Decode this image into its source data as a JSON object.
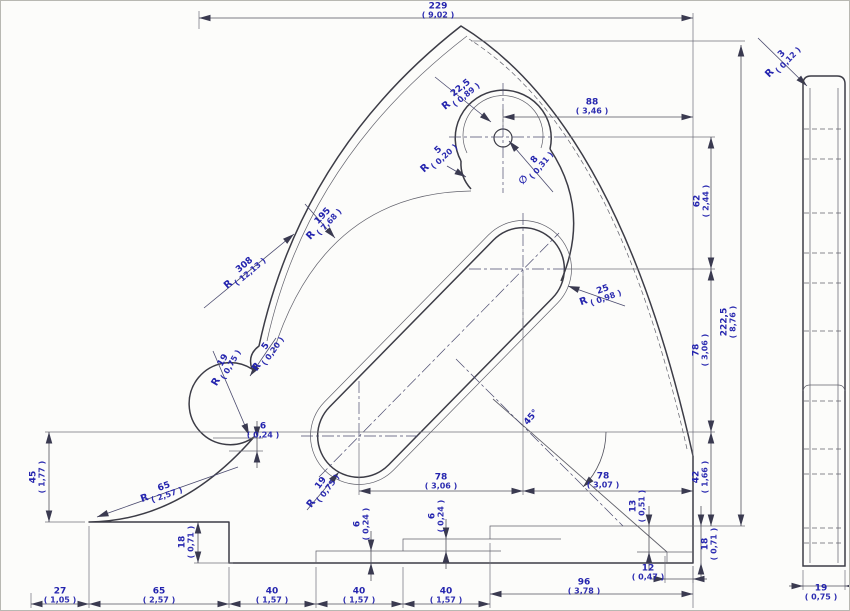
{
  "drawing": {
    "title": "gusset-bracket-technical-drawing",
    "views": {
      "main": "front-view",
      "side": "side-profile-view"
    },
    "colors": {
      "linework": "#3c3c46",
      "thin_line": "#60606a",
      "dimension_text": "#2424ae",
      "background": "#fcfcfa"
    },
    "labels": [
      {
        "name": "dim-overall-width",
        "prefix": "",
        "mm": "229",
        "in": "9,02",
        "x": 437,
        "y": 10,
        "rot": 0
      },
      {
        "name": "dim-hole-offset",
        "prefix": "",
        "mm": "88",
        "in": "3,46",
        "x": 591,
        "y": 106,
        "rot": 0
      },
      {
        "name": "dim-hole-to-slot",
        "prefix": "",
        "mm": "62",
        "in": "2,44",
        "x": 701,
        "y": 200,
        "rot": -90
      },
      {
        "name": "dim-slot-height",
        "prefix": "",
        "mm": "78",
        "in": "3,06",
        "x": 700,
        "y": 349,
        "rot": -90
      },
      {
        "name": "dim-overall-height",
        "prefix": "",
        "mm": "222,5",
        "in": "8,76",
        "x": 728,
        "y": 321,
        "rot": -90
      },
      {
        "name": "dim-edge-height-42",
        "prefix": "",
        "mm": "42",
        "in": "1,66",
        "x": 700,
        "y": 476,
        "rot": -90
      },
      {
        "name": "dim-step-13",
        "prefix": "",
        "mm": "13",
        "in": "0,51",
        "x": 637,
        "y": 505,
        "rot": -90
      },
      {
        "name": "dim-step-18-right",
        "prefix": "",
        "mm": "18",
        "in": "0,71",
        "x": 709,
        "y": 543,
        "rot": -90
      },
      {
        "name": "dim-notch-12",
        "prefix": "",
        "mm": "12",
        "in": "0,47",
        "x": 647,
        "y": 572,
        "rot": 0
      },
      {
        "name": "dim-base-96",
        "prefix": "",
        "mm": "96",
        "in": "3,78",
        "x": 583,
        "y": 586,
        "rot": 0
      },
      {
        "name": "dim-base-40-3",
        "prefix": "",
        "mm": "40",
        "in": "1,57",
        "x": 445,
        "y": 595,
        "rot": 0
      },
      {
        "name": "dim-base-40-2",
        "prefix": "",
        "mm": "40",
        "in": "1,57",
        "x": 358,
        "y": 595,
        "rot": 0
      },
      {
        "name": "dim-base-40-1",
        "prefix": "",
        "mm": "40",
        "in": "1,57",
        "x": 271,
        "y": 595,
        "rot": 0
      },
      {
        "name": "dim-base-65",
        "prefix": "",
        "mm": "65",
        "in": "2,57",
        "x": 158,
        "y": 595,
        "rot": 0
      },
      {
        "name": "dim-base-27",
        "prefix": "",
        "mm": "27",
        "in": "1,05",
        "x": 59,
        "y": 595,
        "rot": 0
      },
      {
        "name": "dim-left-45",
        "prefix": "",
        "mm": "45",
        "in": "1,77",
        "x": 37,
        "y": 476,
        "rot": -90
      },
      {
        "name": "dim-step-18-left",
        "prefix": "",
        "mm": "18",
        "in": "0,71",
        "x": 186,
        "y": 541,
        "rot": -90
      },
      {
        "name": "dim-step-6-left",
        "prefix": "",
        "mm": "6",
        "in": "0,24",
        "x": 262,
        "y": 430,
        "rot": 0
      },
      {
        "name": "dim-step-6-mid",
        "prefix": "",
        "mm": "6",
        "in": "0,24",
        "x": 361,
        "y": 523,
        "rot": -90
      },
      {
        "name": "dim-step-6-right",
        "prefix": "",
        "mm": "6",
        "in": "0,24",
        "x": 436,
        "y": 515,
        "rot": -90
      },
      {
        "name": "dim-slot-span-left",
        "prefix": "",
        "mm": "78",
        "in": "3,06",
        "x": 440,
        "y": 481,
        "rot": 0
      },
      {
        "name": "dim-slot-span-right",
        "prefix": "",
        "mm": "78",
        "in": "3,07",
        "x": 602,
        "y": 480,
        "rot": 0
      },
      {
        "name": "dim-thickness-19",
        "prefix": "",
        "mm": "19",
        "in": "0,75",
        "x": 820,
        "y": 592,
        "rot": 0
      },
      {
        "name": "radius-boss",
        "prefix": "R",
        "mm": "22,5",
        "in": "0,89",
        "x": 459,
        "y": 94,
        "rot": -39
      },
      {
        "name": "diameter-hole",
        "prefix": "∅",
        "mm": "8",
        "in": "0,31",
        "x": 534,
        "y": 166,
        "rot": -50
      },
      {
        "name": "radius-notch-top",
        "prefix": "R",
        "mm": "5",
        "in": "0,20",
        "x": 437,
        "y": 156,
        "rot": -42
      },
      {
        "name": "radius-outer-edge",
        "prefix": "R",
        "mm": "308",
        "in": "12,13",
        "x": 243,
        "y": 271,
        "rot": -40
      },
      {
        "name": "radius-inner-rim",
        "prefix": "R",
        "mm": "195",
        "in": "7,68",
        "x": 322,
        "y": 222,
        "rot": -47
      },
      {
        "name": "radius-slot-end-25",
        "prefix": "R",
        "mm": "25",
        "in": "0,98",
        "x": 599,
        "y": 295,
        "rot": -20
      },
      {
        "name": "radius-slot-end-19",
        "prefix": "R",
        "mm": "19",
        "in": "0,75",
        "x": 321,
        "y": 489,
        "rot": -53
      },
      {
        "name": "radius-notch-left",
        "prefix": "R",
        "mm": "5",
        "in": "0,20",
        "x": 266,
        "y": 352,
        "rot": -55
      },
      {
        "name": "radius-bump-left",
        "prefix": "R",
        "mm": "19",
        "in": "0,75",
        "x": 224,
        "y": 366,
        "rot": -60
      },
      {
        "name": "radius-foot-fillet",
        "prefix": "R",
        "mm": "65",
        "in": "2,57",
        "x": 160,
        "y": 492,
        "rot": -19
      },
      {
        "name": "radius-side-edge",
        "prefix": "R",
        "mm": "3",
        "in": "0,12",
        "x": 781,
        "y": 60,
        "rot": -46
      },
      {
        "name": "angle-slot",
        "prefix": "",
        "mm": "45°",
        "in": null,
        "x": 531,
        "y": 417,
        "rot": -50
      }
    ]
  }
}
